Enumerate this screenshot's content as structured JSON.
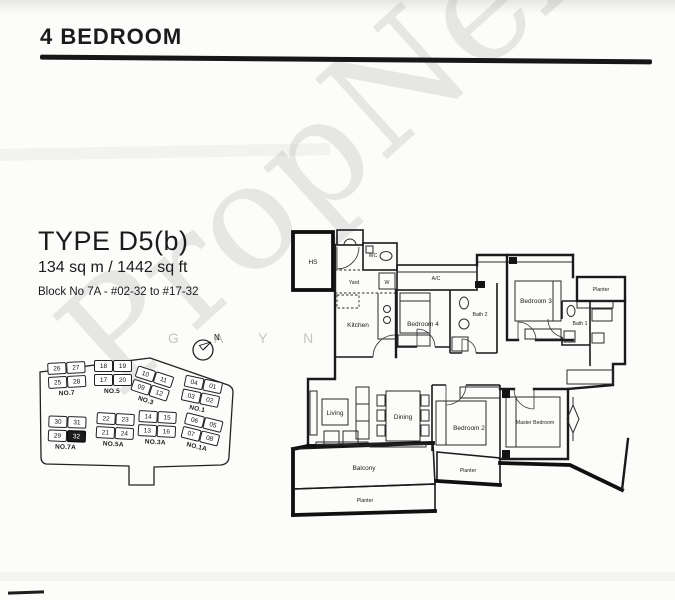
{
  "page": {
    "title": "4 BEDROOM"
  },
  "unit": {
    "type": "TYPE D5(b)",
    "area": "134 sq m / 1442 sq ft",
    "block_range": "Block No 7A - #02-32 to #17-32"
  },
  "watermark": {
    "diagonal": "PropNex",
    "faint": "G A Y N"
  },
  "compass": {
    "label": "N"
  },
  "site_plan": {
    "highlighted_unit": "32",
    "blocks": [
      {
        "name": "NO.7",
        "units": [
          "26",
          "27",
          "25",
          "28"
        ]
      },
      {
        "name": "NO.5",
        "units": [
          "18",
          "19",
          "17",
          "20"
        ]
      },
      {
        "name": "NO.3",
        "units": [
          "10",
          "11",
          "09",
          "12"
        ]
      },
      {
        "name": "NO.1",
        "units": [
          "04",
          "01",
          "03",
          "02"
        ]
      },
      {
        "name": "NO.7A",
        "units": [
          "30",
          "31",
          "29",
          "32"
        ]
      },
      {
        "name": "NO.5A",
        "units": [
          "22",
          "23",
          "21",
          "24"
        ]
      },
      {
        "name": "NO.3A",
        "units": [
          "14",
          "15",
          "13",
          "16"
        ]
      },
      {
        "name": "NO.1A",
        "units": [
          "06",
          "05",
          "07",
          "08"
        ]
      }
    ]
  },
  "floor_plan": {
    "rooms": [
      {
        "label": "HS"
      },
      {
        "label": "WC"
      },
      {
        "label": "Yard"
      },
      {
        "label": "W"
      },
      {
        "label": "A/C"
      },
      {
        "label": "Kitchen"
      },
      {
        "label": "Bedroom 4"
      },
      {
        "label": "Bath 2"
      },
      {
        "label": "Bedroom 3"
      },
      {
        "label": "Planter"
      },
      {
        "label": "Bath 1"
      },
      {
        "label": "Living"
      },
      {
        "label": "Dining"
      },
      {
        "label": "Bedroom 2"
      },
      {
        "label": "Master Bedroom"
      },
      {
        "label": "Balcony"
      },
      {
        "label": "Planter"
      },
      {
        "label": "Planter"
      }
    ]
  }
}
